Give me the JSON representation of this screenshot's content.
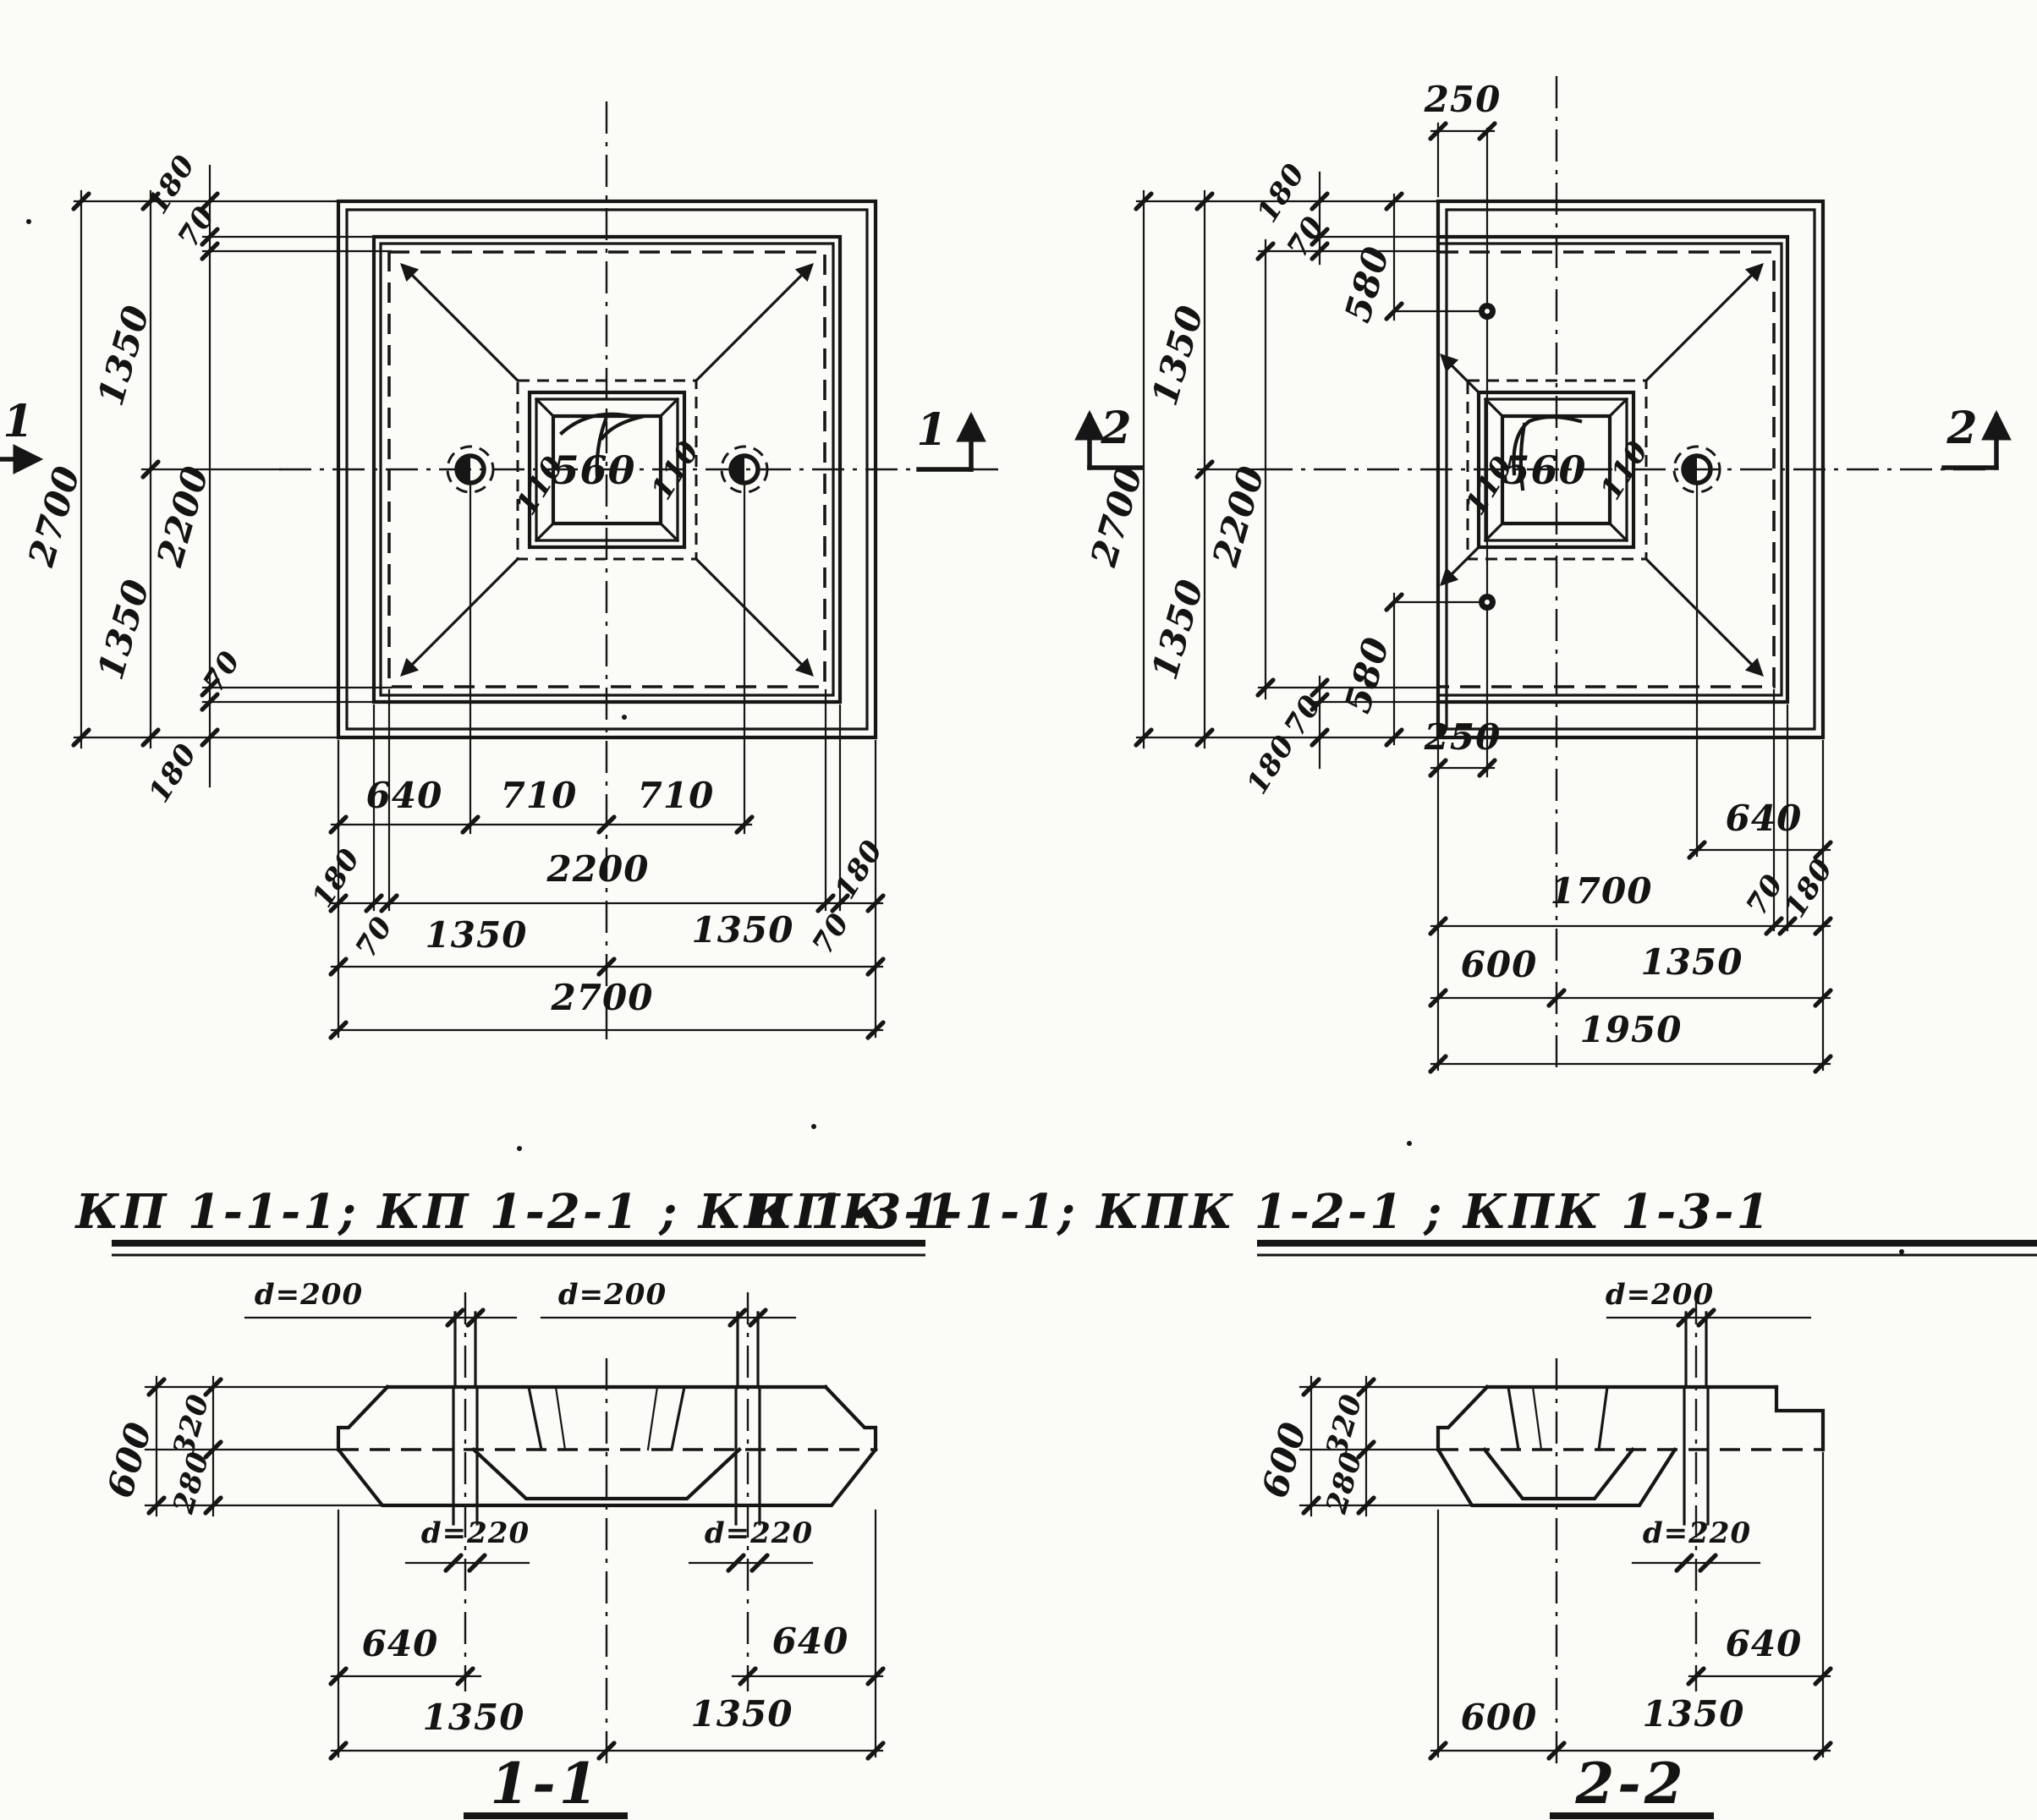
{
  "colors": {
    "ink": "#161616",
    "paper": "#fbfbf8"
  },
  "lp": {
    "marker": "1",
    "socket": "560",
    "bevelL": "110",
    "bevelR": "110",
    "v2700": "2700",
    "v1350a": "1350",
    "v1350b": "1350",
    "v180t": "180",
    "v70t": "70",
    "v2200": "2200",
    "v70b": "70",
    "v180b": "180",
    "h640": "640",
    "h710a": "710",
    "h710b": "710",
    "h180l": "180",
    "h70l": "70",
    "h2200": "2200",
    "h70r": "70",
    "h180r": "180",
    "h1350a": "1350",
    "h1350b": "1350",
    "h2700": "2700"
  },
  "rp": {
    "marker": "2",
    "socket": "560",
    "bevelL": "110",
    "bevelR": "110",
    "t250": "250",
    "b250": "250",
    "v2700": "2700",
    "v1350a": "1350",
    "v1350b": "1350",
    "v2200": "2200",
    "v180t": "180",
    "v70t": "70",
    "v580t": "580",
    "v70b": "70",
    "v180b": "180",
    "v580b": "580",
    "h640": "640",
    "h1700": "1700",
    "h70": "70",
    "h180": "180",
    "h600": "600",
    "h1350": "1350",
    "h1950": "1950"
  },
  "titles": {
    "left": "КП 1-1-1; КП 1-2-1 ; КП 1-3-1",
    "right": "КПК 1-1-1; КПК 1-2-1 ; КПК 1-3-1"
  },
  "s1": {
    "label": "1-1",
    "d200l": "d=200",
    "d200r": "d=200",
    "d220l": "d=220",
    "d220r": "d=220",
    "h600": "600",
    "h320": "320",
    "h280": "280",
    "b640l": "640",
    "b640r": "640",
    "b1350l": "1350",
    "b1350r": "1350"
  },
  "s2": {
    "label": "2-2",
    "d200": "d=200",
    "d220": "d=220",
    "h600": "600",
    "h320": "320",
    "h280": "280",
    "b640": "640",
    "b600": "600",
    "b1350": "1350"
  }
}
